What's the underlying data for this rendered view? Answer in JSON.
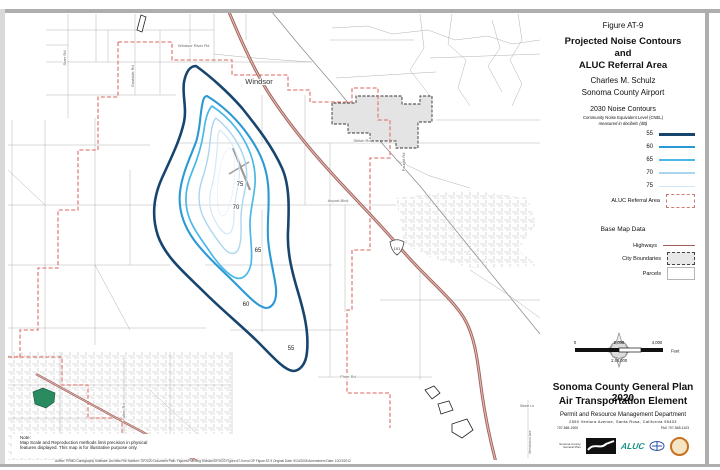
{
  "page": {
    "figure_label": "Figure AT-9",
    "title1": "Projected Noise Contours",
    "title2": "and",
    "title3": "ALUC Referral Area",
    "subtitle1": "Charles M. Schulz",
    "subtitle2": "Sonoma County Airport"
  },
  "legend": {
    "noise": {
      "title": "2030 Noise Contours",
      "subtitle1": "Community Noise Equivalent Level (CNEL)",
      "subtitle2": "measured in decibels (dB)",
      "entries": [
        {
          "label": "55",
          "color": "#17456e"
        },
        {
          "label": "60",
          "color": "#2b99d4"
        },
        {
          "label": "65",
          "color": "#49b8e8"
        },
        {
          "label": "70",
          "color": "#a9d5ef"
        },
        {
          "label": "75",
          "color": "#cfe7f6"
        }
      ],
      "aluc_label": "ALUC Referral Area",
      "aluc_border_color": "#cc7b74"
    },
    "base": {
      "title": "Base Map Data",
      "rows": [
        {
          "label": "Highways"
        },
        {
          "label": "City Boundaries"
        },
        {
          "label": "Parcels"
        }
      ],
      "highway_color": "#a2625b"
    }
  },
  "scalebar": {
    "zero": "0",
    "mid": "2,000",
    "max": "4,000",
    "unit": "Feet",
    "ratio": "1:48,000"
  },
  "footer": {
    "plan_title": "Sonoma County General Plan 2020",
    "element_title": "Air Transportation Element",
    "department": "Permit and Resource Management Department",
    "address": "2550 Ventura Avenue, Santa Rosa, California 95403",
    "phone": "707-565-1900",
    "fax": "FAX 707-565-1103",
    "logo_caption": "Sonoma County General Plan",
    "aluc_logo_text": "ALUC"
  },
  "map": {
    "city_label": "Windsor",
    "highway_shield": "101",
    "contour_labels": [
      "75",
      "70",
      "65",
      "60",
      "55"
    ],
    "roads": [
      {
        "label": "Windsor River Rd"
      },
      {
        "label": "Starr Rd"
      },
      {
        "label": "Eastside Rd"
      },
      {
        "label": "Shiloh Rd"
      },
      {
        "label": "Faught Rd"
      },
      {
        "label": "Airport Blvd"
      },
      {
        "label": "Piner Rd"
      },
      {
        "label": "Fulton Rd"
      },
      {
        "label": "Steele Ln"
      },
      {
        "label": "Mendocino Ave"
      }
    ],
    "note_title": "Note:",
    "note_line1": "Map Scale and Reproduction methods limit precision in physical",
    "note_line2": "features displayed. This map is for illustrative purpose only.",
    "fine_print": "Author: PRMD Cartography   Software: ArcView   File Number: GP2020   Document Path: Figures/Planning Division/GP2020 Figure AT-9.mxd   GP Figure AT-9   Original Date: 9/24/2008   Amendment Date: 10/23/2012"
  }
}
